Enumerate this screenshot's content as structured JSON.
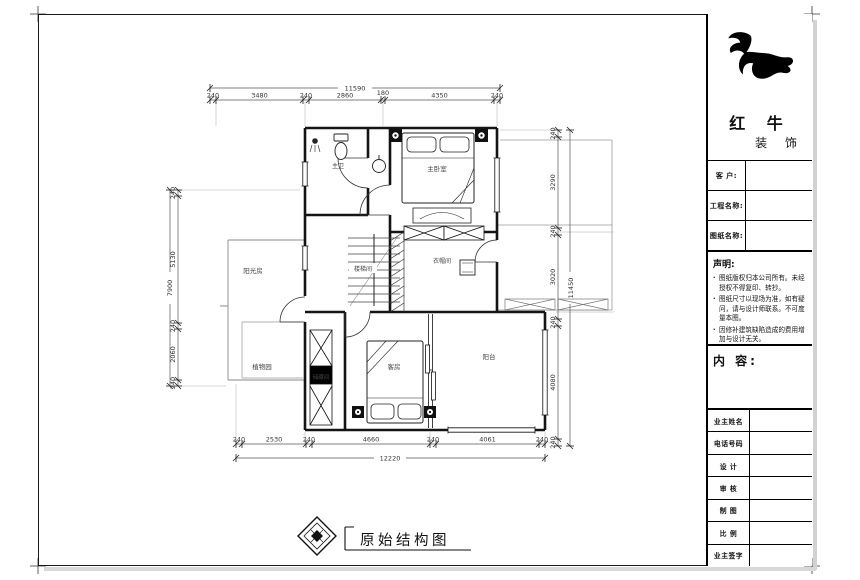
{
  "brand": {
    "name": "红 牛",
    "suffix": "装 饰",
    "logo": "bull-logo"
  },
  "title_block": {
    "fields": [
      {
        "label": "客 户:"
      },
      {
        "label": "工程名称:"
      },
      {
        "label": "图纸名称:"
      }
    ],
    "statement": {
      "heading": "声明:",
      "items": [
        "图纸版权归本公司所有。未经授权不得复印、转抄。",
        "图纸尺寸以现场为准，如有疑问，请与设计师联系。不可度量本图。",
        "因修补建筑缺陷造成的费用增加与设计无关。"
      ]
    },
    "content_heading": "内 容:",
    "sign_rows": [
      {
        "label": "业主姓名"
      },
      {
        "label": "电话号码"
      },
      {
        "label": "设 计"
      },
      {
        "label": "审 核"
      },
      {
        "label": "制 图"
      },
      {
        "label": "比 例"
      },
      {
        "label": "业主签字"
      }
    ]
  },
  "rooms": {
    "master_bath": "主卫",
    "master_bedroom": "主卧室",
    "stairwell": "楼梯间",
    "cloakroom": "衣帽间",
    "sunroom": "阳光房",
    "plant_garden": "植物园",
    "storage": "储藏间",
    "guest_room": "客房",
    "balcony": "阳台"
  },
  "dims": {
    "top": {
      "overall": "11590",
      "s": [
        "240",
        "3480",
        "240",
        "2860",
        "180",
        "4350",
        "240"
      ]
    },
    "bottom": {
      "overall": "12220",
      "s": [
        "240",
        "2530",
        "240",
        "4660",
        "240",
        "4061",
        "240"
      ]
    },
    "left": {
      "overall": "7900",
      "s": [
        "240",
        "5130",
        "240",
        "2060",
        "240"
      ]
    },
    "right": {
      "overall": "11450",
      "s": [
        "240",
        "3290",
        "240",
        "3020",
        "240",
        "4080",
        "240"
      ]
    }
  },
  "footer": {
    "drawing_title": "原始结构图"
  }
}
